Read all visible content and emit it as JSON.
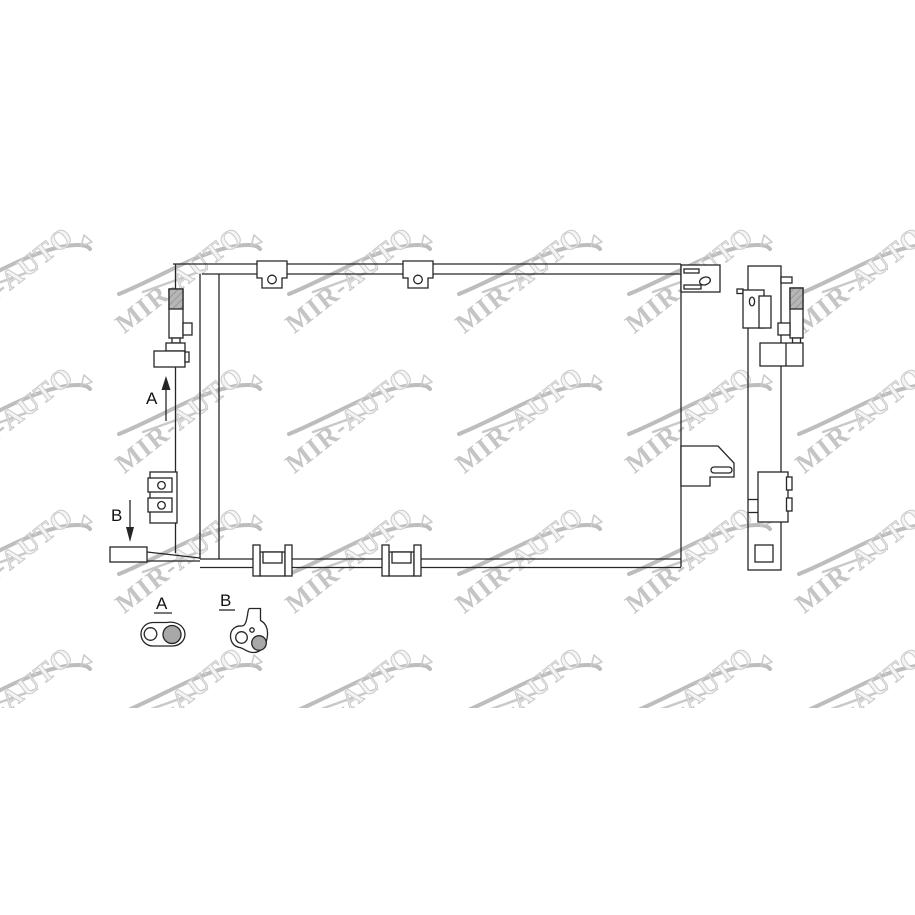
{
  "watermark": {
    "text": "MIR-AUTO",
    "text_solid": "MIR-",
    "text_hollow": "AUTO"
  },
  "diagram": {
    "arrow_labels": {
      "a": "A",
      "b": "B"
    },
    "detail_views": [
      {
        "label": "A"
      },
      {
        "label": "B"
      }
    ],
    "colors": {
      "line": "#262626",
      "component_gray": "#a8a8a8",
      "hatch_gray": "#b6b6b6",
      "watermark_solid": "#c5c5c5",
      "watermark_hollow_outline": "#cbcbcb"
    }
  }
}
